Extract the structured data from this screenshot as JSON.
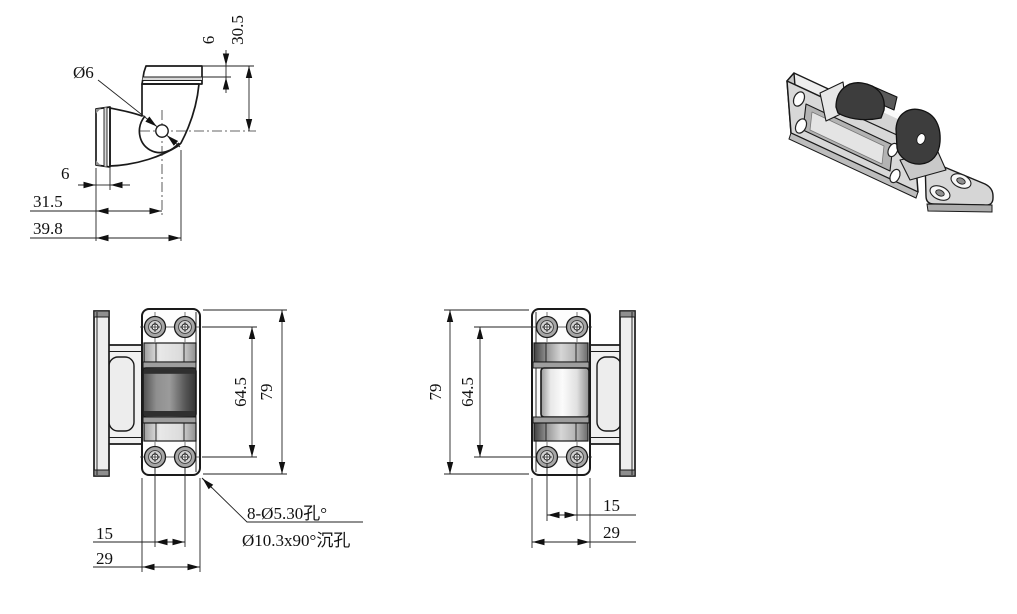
{
  "side_view": {
    "dims": {
      "hole_diameter": "Ø6",
      "plate_thickness": "6",
      "height_to_center": "30.5",
      "flange_thickness": "6",
      "center_offset": "31.5",
      "overall_depth": "39.8"
    }
  },
  "front_view": {
    "dims": {
      "hole_span_vertical": "64.5",
      "overall_height": "79",
      "hole_span_horizontal": "15",
      "plate_width": "29"
    },
    "hole_note": {
      "line1": "8-Ø5.30孔°",
      "line2": "Ø10.3x90°沉孔"
    }
  },
  "back_view": {
    "dims": {
      "overall_height": "79",
      "hole_span_vertical": "64.5",
      "hole_span_horizontal": "15",
      "plate_width": "29"
    }
  },
  "colors": {
    "background": "#ffffff",
    "line": "#1a1a1a",
    "fill_light": "#f3f3f3",
    "fill_mid": "#d8d8d8",
    "barrel_dark": "#4a4a4a",
    "barrel_light": "#f2f2f2",
    "counterbore_gray": "#a6a6a6",
    "dark_part": "#3d3d3d",
    "flange_cap": "#8f8f8f"
  }
}
